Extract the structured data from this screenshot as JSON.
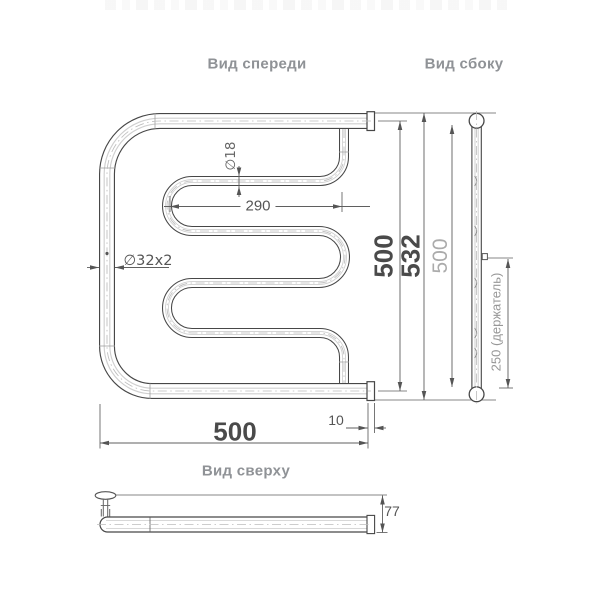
{
  "colors": {
    "background": "#ffffff",
    "pipe_line": "#474747",
    "dim_line": "#5f5f5f",
    "centerline": "#bdbdbd",
    "dim_text": "#555555",
    "big_dim_text": "#4a4a4a",
    "side_dim_text": "#ababab",
    "holder_dim_text": "#979797",
    "view_label_text": "#8f9296"
  },
  "views": {
    "front": {
      "label": "Вид спереди",
      "dims": {
        "pipe_diameter": "∅18",
        "inner_width": "290",
        "main_pipe": "∅32x2",
        "height": "500",
        "overall_height": "532",
        "width": "500",
        "end_offset": "10"
      }
    },
    "side": {
      "label": "Вид сбоку",
      "dims": {
        "height": "500",
        "holder_spacing": "250 (держатель)"
      }
    },
    "top": {
      "label": "Вид сверху",
      "dims": {
        "depth": "77"
      }
    }
  }
}
